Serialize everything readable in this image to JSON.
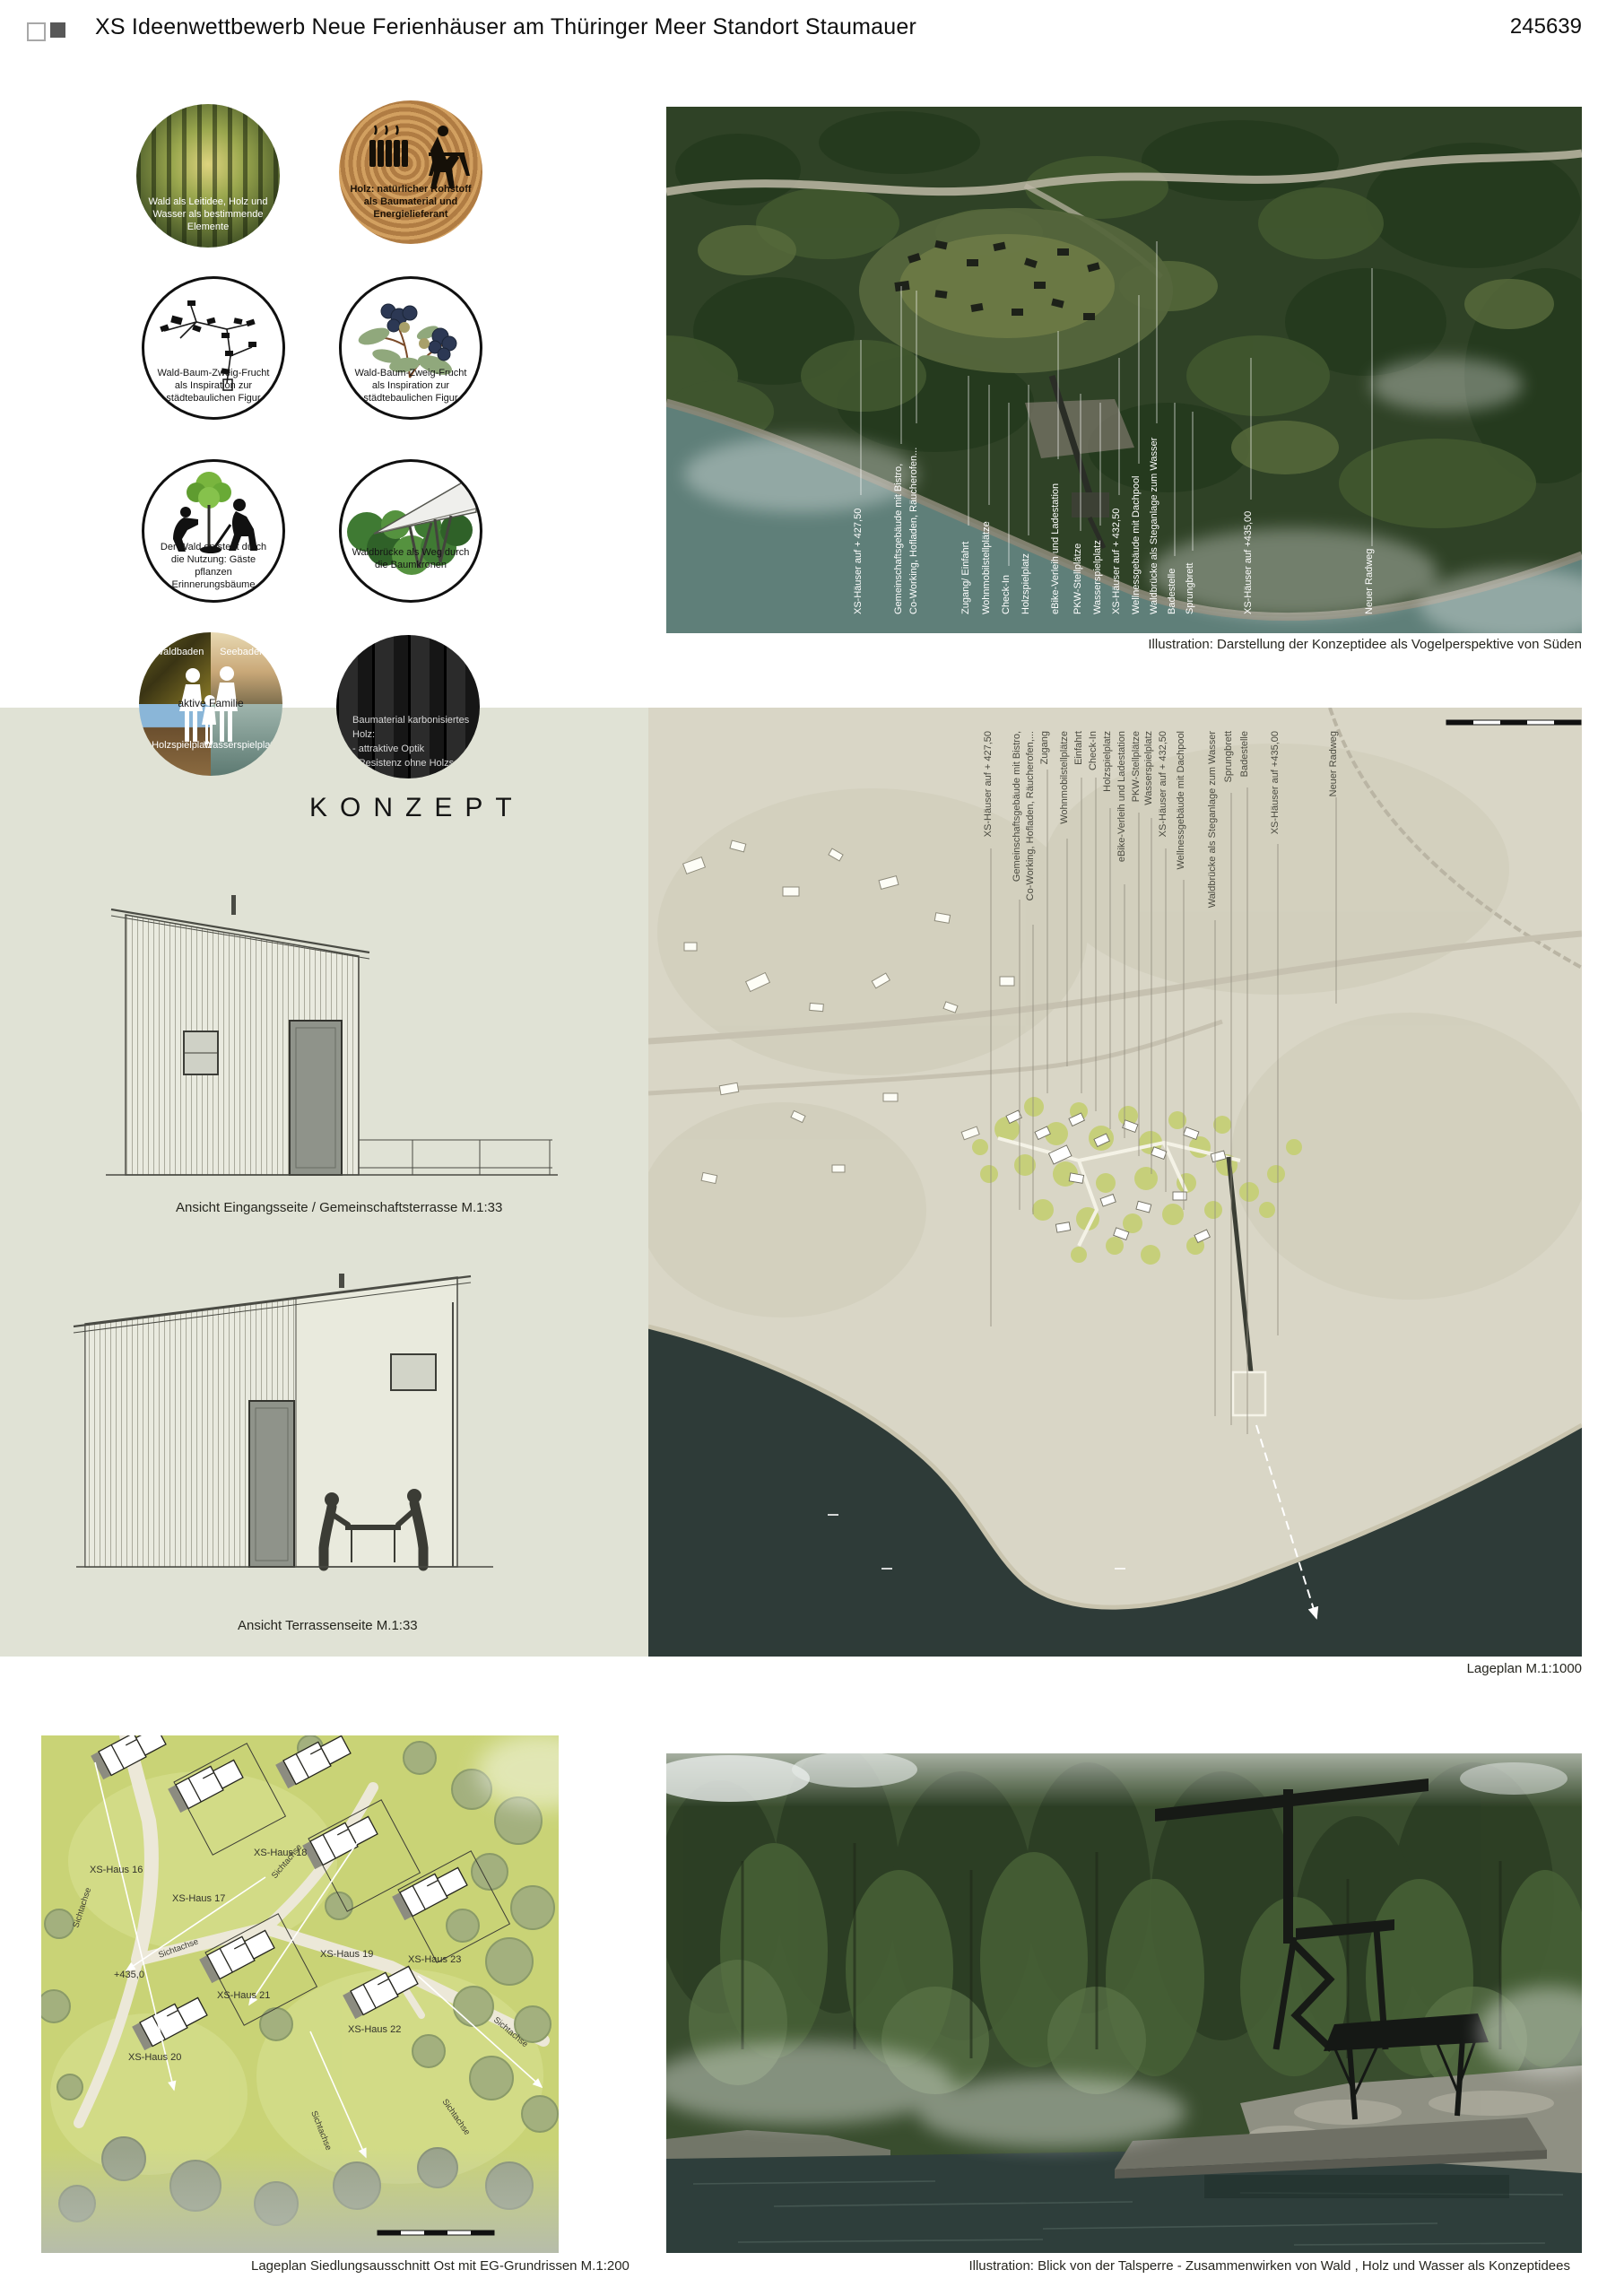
{
  "header": {
    "title": "XS Ideenwettbewerb Neue Ferienhäuser am Thüringer Meer Standort Staumauer",
    "code": "245639"
  },
  "concept": {
    "heading": "KONZEPT"
  },
  "circles": [
    {
      "caption": "Wald als Leitidee, Holz und Wasser als bestimmende Elemente"
    },
    {
      "caption": "Holz: natürlicher Rohstoff als Baumaterial und Energielieferant"
    },
    {
      "caption": "Wald-Baum-Zweig-Frucht als Inspiration zur städtebaulichen Figur"
    },
    {
      "caption": "Wald-Baum-Zweig-Frucht als Inspiration zur städtebaulichen Figur"
    },
    {
      "caption": "Der Wald entsteht durch die Nutzung: Gäste pflanzen Erinnerungsbäume"
    },
    {
      "caption": "Waldbrücke als Weg durch die Baumkronen"
    },
    {
      "center": "aktive Familie",
      "tl": "Waldbaden",
      "tr": "Seebaden",
      "bl": "Holzspielplatz",
      "br": "Wasserspielplatz"
    },
    {
      "lines": [
        "Baumaterial karbonisiertes Holz:",
        "- attraktive Optik",
        "- Resistenz ohne Holzschutz"
      ]
    }
  ],
  "aerial": {
    "caption": "Illustration: Darstellung der Konzeptidee als Vogelperspektive von Süden",
    "labels": [
      "XS-Häuser auf + 427,50",
      "Gemeinschaftsgebäude mit Bistro,",
      "Co-Working, Hofladen, Räucherofen...",
      "Zugang/ Einfahrt",
      "Wohnmobilstellplätze",
      "Check-In",
      "Holzspielplatz",
      "eBike-Verleih und Ladestation",
      "PKW-Stellplätze",
      "Wasserspielplatz",
      "XS-Häuser auf + 432,50",
      "Wellnessgebäude mit Dachpool",
      "Waldbrücke als Steganlage zum Wasser",
      "Badestelle",
      "Sprungbrett",
      "XS-Häuser auf +435,00",
      "Neuer Radweg"
    ]
  },
  "siteplan": {
    "caption": "Lageplan M.1:1000",
    "labels": [
      "XS-Häuser auf + 427,50",
      "Gemeinschaftsgebäude mit Bistro,",
      "Co-Working, Hofladen, Räucherofen,...",
      "Zugang",
      "Wohnmobilstellplätze",
      "Einfahrt",
      "Check-In",
      "Holzspielplatz",
      "eBike-Verleih und Ladestation",
      "PKW-Stellplätze",
      "Wasserspielplatz",
      "XS-Häuser auf + 432,50",
      "Wellnessgebäude mit Dachpool",
      "Waldbrücke als Steganlage zum Wasser",
      "Sprungbrett",
      "Badestelle",
      "XS-Häuser auf +435,00",
      "Neuer Radweg"
    ]
  },
  "elevations": {
    "entrance_caption": "Ansicht Eingangsseite / Gemeinschaftsterrasse M.1:33",
    "terrace_caption": "Ansicht Terrassenseite M.1:33"
  },
  "detailplan": {
    "caption": "Lageplan Siedlungsausschnitt Ost mit EG-Grundrissen M.1:200",
    "houses": [
      "XS-Haus 16",
      "XS-Haus 17",
      "XS-Haus 18",
      "XS-Haus 19",
      "XS-Haus 20",
      "XS-Haus 21",
      "XS-Haus 22",
      "XS-Haus 23"
    ],
    "level": "+435,0",
    "axis": "Sichtachse"
  },
  "perspective": {
    "caption": "Illustration: Blick von der Talsperre - Zusammenwirken von Wald , Holz und Wasser als Konzeptidees"
  }
}
